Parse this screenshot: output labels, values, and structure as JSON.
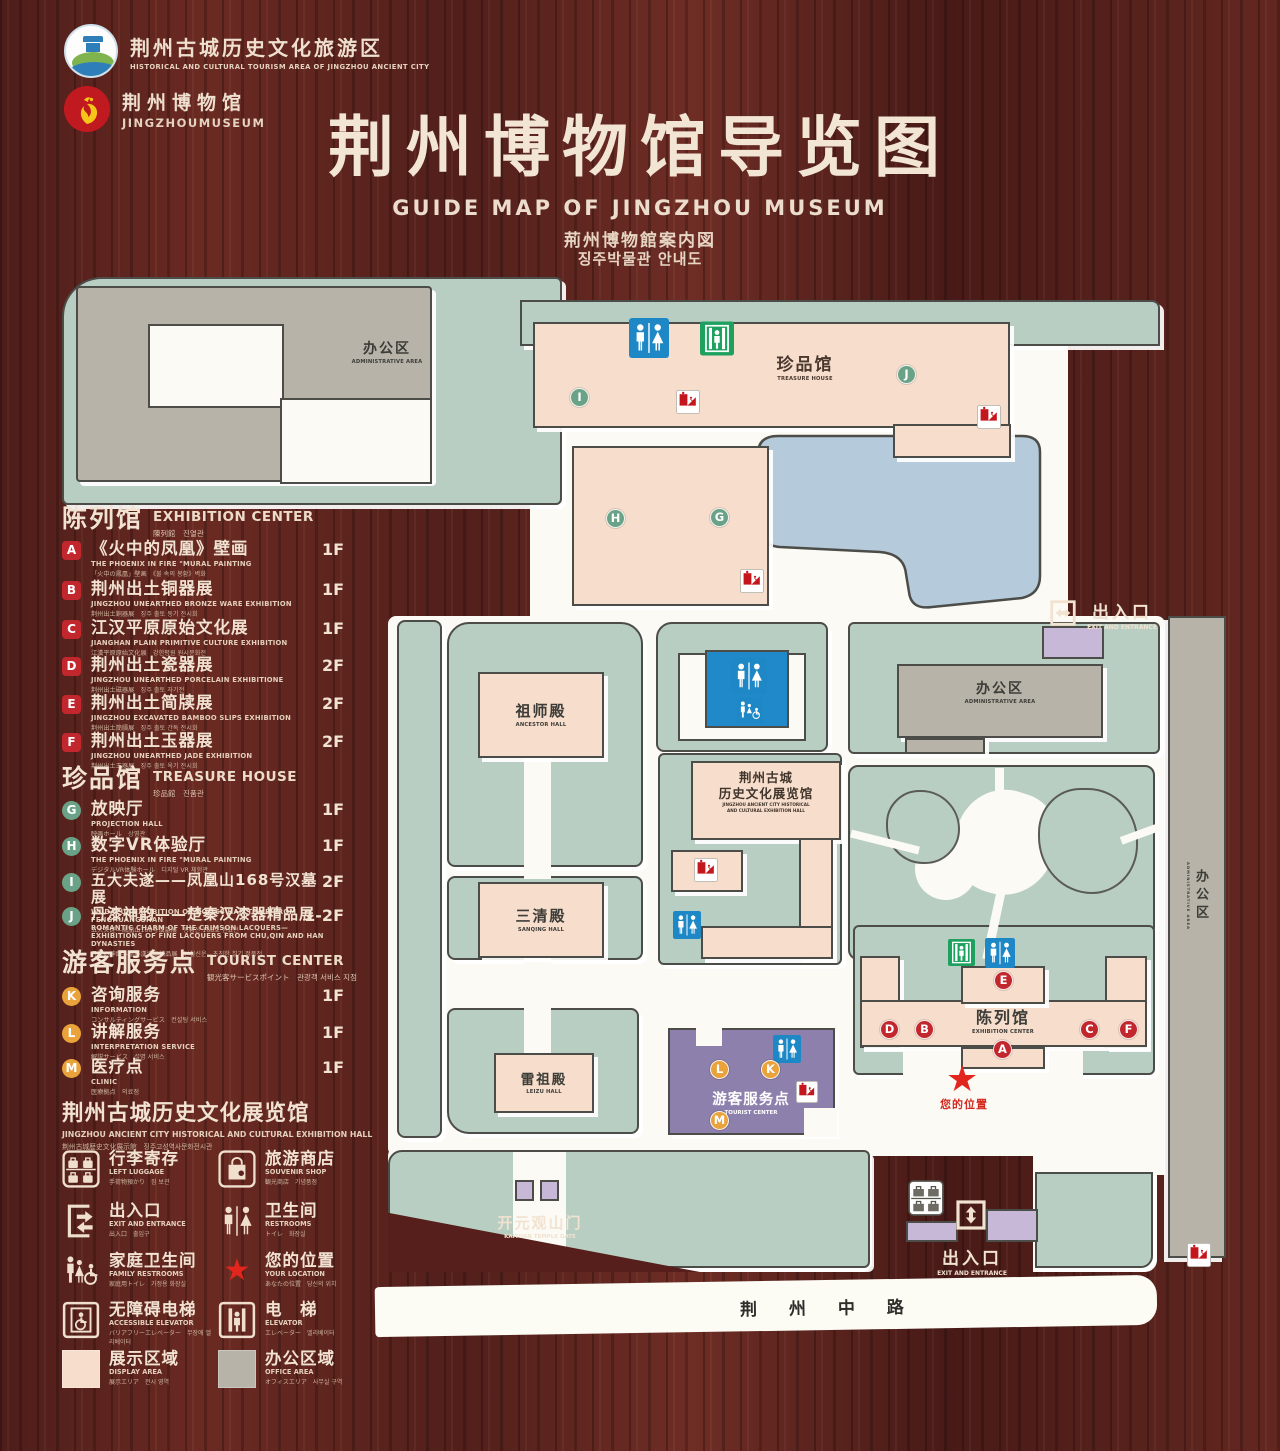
{
  "header": {
    "logo1": {
      "zh": "荆州古城历史文化旅游区",
      "en": "HISTORICAL AND CULTURAL TOURISM AREA OF JINGZHOU ANCIENT CITY"
    },
    "logo2": {
      "zh": "荆州博物馆",
      "en": "JINGZHOUMUSEUM"
    },
    "title": "荆州博物馆导览图",
    "subtitle_en": "GUIDE MAP OF JINGZHOU MUSEUM",
    "subtitle_ja": "荊州博物館案内図",
    "subtitle_ko": "징주박물관 안내도"
  },
  "legend": {
    "sections": [
      {
        "id": "exhibition-center",
        "title_zh": "陈列馆",
        "title_en": "EXHIBITION CENTER",
        "title_sub": "陳列館　진열관",
        "items": [
          {
            "key": "A",
            "zh": "《火中的凤凰》壁画",
            "en": "THE PHOENIX IN FIRE \"MURAL PAINTING",
            "sub": "「火中の鳳凰」壁画　《불 속의 봉황》벽화",
            "floor": "1F"
          },
          {
            "key": "B",
            "zh": "荆州出土铜器展",
            "en": "JINGZHOU UNEARTHED BRONZE WARE EXHIBITION",
            "sub": "荆州出土銅器展　징주 출토 동기 전시회",
            "floor": "1F"
          },
          {
            "key": "C",
            "zh": "江汉平原原始文化展",
            "en": "JIANGHAN PLAIN PRIMITIVE CULTURE EXHIBITION",
            "sub": "江漢平原原始文化展　강한평원 원시문화전",
            "floor": "1F"
          },
          {
            "key": "D",
            "zh": "荆州出土瓷器展",
            "en": "JINGZHOU UNEARTHED PORCELAIN EXHIBITIONE",
            "sub": "荆州出土磁器展　징주 출토 자기전",
            "floor": "2F"
          },
          {
            "key": "E",
            "zh": "荆州出土简牍展",
            "en": "JINGZHOU EXCAVATED BAMBOO SLIPS EXHIBITION",
            "sub": "荆州出土簡牘展　징주 출토 간독 전시회",
            "floor": "2F"
          },
          {
            "key": "F",
            "zh": "荆州出土玉器展",
            "en": "JINGZHOU UNEARTHED JADE EXHIBITION",
            "sub": "荆州出土玉器展　징주 출토 옥기 전시회",
            "floor": "2F"
          }
        ]
      },
      {
        "id": "treasure-house",
        "title_zh": "珍品馆",
        "title_en": "TREASURE HOUSE",
        "title_sub": "珍品館　진품관",
        "items": [
          {
            "key": "G",
            "zh": "放映厅",
            "en": "PROJECTION HALL",
            "sub": "映画ホール　상영관",
            "floor": "1F"
          },
          {
            "key": "H",
            "zh": "数字VR体验厅",
            "en": "THE PHOENIX IN FIRE \"MURAL PAINTING",
            "sub": "デジタルVR体験ホール　디지털 VR 체험관",
            "floor": "1F"
          },
          {
            "key": "I",
            "zh": "五大夫遂——凤凰山168号汉墓展",
            "en": "WUDAFU—EXHIBITION OF NO.168 HAN TOMB FROM FENGHUANGSHAN",
            "sub": "五大夫遂—鳳凰山168号漢墓展　봉황산 168호 한묘전",
            "floor": "2F"
          },
          {
            "key": "J",
            "zh": "丹漆神韵——楚秦汉漆器精品展",
            "en": "ROMANTIC CHARM OF THE CRIMSON LACQUERS— EXHIBITIONS OF FINE LACQUERS FROM CHU,QIN AND HAN DYNASTIES",
            "sub": "丹漆の神韻—楚秦漢漆器精品展　단칠신운—초진한 칠기 정품전",
            "floor": "1-2F"
          }
        ]
      },
      {
        "id": "tourist-center",
        "title_zh": "游客服务点",
        "title_en": "TOURIST CENTER",
        "title_sub": "観光客サービスポイント　관광객 서비스 지점",
        "items": [
          {
            "key": "K",
            "zh": "咨询服务",
            "en": "INFORMATION",
            "sub": "コンサルティングサービス　컨설팅 서비스",
            "floor": "1F"
          },
          {
            "key": "L",
            "zh": "讲解服务",
            "en": "INTERPRETATION SERVICE",
            "sub": "解説サービス　설명 서비스",
            "floor": "1F"
          },
          {
            "key": "M",
            "zh": "医疗点",
            "en": "CLINIC",
            "sub": "医療拠点　의료점",
            "floor": "1F"
          }
        ]
      }
    ],
    "hall_note": {
      "zh": "荆州古城历史文化展览馆",
      "en": "JINGZHOU ANCIENT CITY HISTORICAL AND CULTURAL EXHIBITION HALL",
      "sub": "荆州古城歴史文化展示館　징주고성역사문화전시관"
    },
    "icons": [
      {
        "name": "left-luggage",
        "zh": "行李寄存",
        "en": "LEFT LUGGAGE",
        "sub": "手荷物預かり　짐 보관"
      },
      {
        "name": "souvenir-shop",
        "zh": "旅游商店",
        "en": "SOUVENIR SHOP",
        "sub": "観光商店　기념품점"
      },
      {
        "name": "exit-entrance",
        "zh": "出入口",
        "en": "EXIT AND ENTRANCE",
        "sub": "出入口　출입구"
      },
      {
        "name": "restrooms",
        "zh": "卫生间",
        "en": "RESTROOMS",
        "sub": "トイレ　화장실"
      },
      {
        "name": "family-restrooms",
        "zh": "家庭卫生间",
        "en": "FAMILY RESTROOMS",
        "sub": "家庭用トイレ　가정용 화장실"
      },
      {
        "name": "your-location",
        "zh": "您的位置",
        "en": "YOUR LOCATION",
        "sub": "あなたの位置　당신의 위치"
      },
      {
        "name": "accessible-elevator",
        "zh": "无障碍电梯",
        "en": "ACCESSIBLE ELEVATOR",
        "sub": "バリアフリーエレベーター　무장애 엘리베이터"
      },
      {
        "name": "elevator",
        "zh": "电　梯",
        "en": "ELEVATOR",
        "sub": "エレベーター　엘리베이터"
      }
    ],
    "areas": [
      {
        "name": "display-area",
        "zh": "展示区域",
        "en": "DISPLAY AREA",
        "sub": "展示エリア　전시 영역",
        "color": "#f7ddcb"
      },
      {
        "name": "office-area",
        "zh": "办公区域",
        "en": "OFFICE AREA",
        "sub": "オフィスエリア　사무실 구역",
        "color": "#b7b3a8"
      }
    ]
  },
  "map": {
    "admin_tl": {
      "zh": "办公区",
      "en": "ADMINISTRATIVE AREA"
    },
    "treasure": {
      "zh": "珍品馆",
      "en": "TREASURE HOUSE"
    },
    "ancestor": {
      "zh": "祖师殿",
      "en": "ANCESTOR HALL"
    },
    "sanqing": {
      "zh": "三清殿",
      "en": "SANQING HALL"
    },
    "leizu": {
      "zh": "雷祖殿",
      "en": "LEIZU HALL"
    },
    "jz_hall": {
      "zh1": "荆州古城",
      "zh2": "历史文化展览馆",
      "en1": "JINGZHOU ANCIENT CITY HISTORICAL",
      "en2": "AND CULTURAL EXHIBITION HALL"
    },
    "admin_right": {
      "zh": "办公区",
      "en": "ADMINISTRATIVE AREA"
    },
    "admin_strip": {
      "zh": "办公区",
      "en": "ADMINISTRATIVE AREA"
    },
    "exhibition": {
      "zh": "陈列馆",
      "en": "EXHIBITION CENTER"
    },
    "tourist": {
      "zh": "游客服务点",
      "en": "TOURIST CENTER"
    },
    "gate": {
      "zh": "开元观山门",
      "en": "KAIYUAN TEMPLE GATE"
    },
    "exit_top": {
      "zh": "出入口",
      "en": "EXIT AND ENTRANCE"
    },
    "exit_bottom": {
      "zh": "出入口",
      "en": "EXIT AND ENTRANCE"
    },
    "road": "荆 州 中 路",
    "your_location": "您的位置",
    "markers": {
      "A": "A",
      "B": "B",
      "C": "C",
      "D": "D",
      "E": "E",
      "F": "F",
      "G": "G",
      "H": "H",
      "I": "I",
      "J": "J",
      "K": "K",
      "L": "L",
      "M": "M"
    }
  },
  "colors": {
    "display_area": "#f7ddcb",
    "office_area": "#b7b3a8",
    "ground_green": "#b9cec2",
    "water_blue": "#b5cbdb",
    "tourist_purple": "#8e80ac",
    "marker_red": "#c2272e",
    "marker_green": "#6aa287",
    "marker_orange": "#eaa23b",
    "restroom_blue": "#1e88c7",
    "elevator_green": "#1ea15f",
    "escalator_red": "#c4161d",
    "star_red": "#e2261d"
  }
}
